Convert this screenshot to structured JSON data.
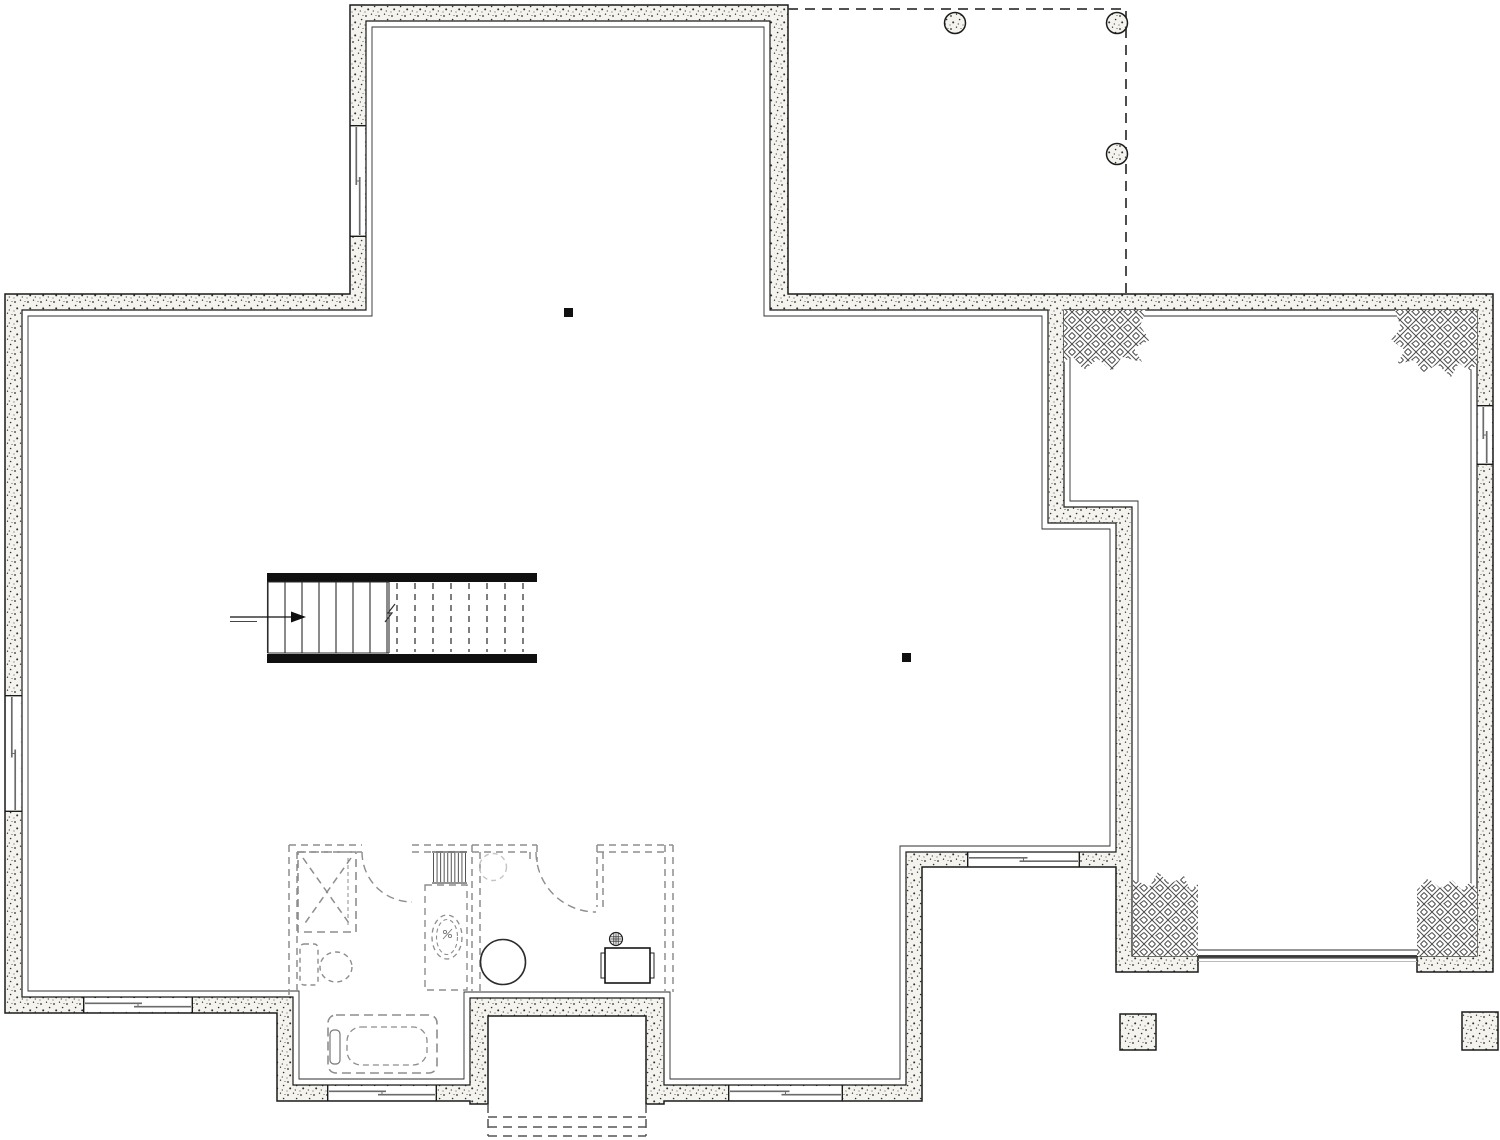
{
  "canvas": {
    "width": 1500,
    "height": 1140
  },
  "colors": {
    "line": "#1b1b1b",
    "face": "#2e2e2e",
    "wall_fill": "#f4f3ee",
    "stipple_dot": "#2f2f2f",
    "hatch": "#4c4c4c",
    "glazing": "#6b6b6b",
    "dash_dark": "#3a3a3a",
    "dash_gray": "#8d8d8d",
    "dash_light": "#c4c4c4",
    "steel": "#101010",
    "background": "#ffffff"
  },
  "outline": {
    "outer": "M350,5 L788,5 L788,294 L1493,294 L1493,972 L1417,972 L1417,956 L1198,956 L1198,972 L1116,972 L1116,867 L922,867 L922,1101 L664,1101 L664,1104 L646,1104 L646,1016 L488,1016 L488,1104 L470,1104 L470,1101 L277,1101 L277,1013 L5,1013 L5,294 L350,294 Z",
    "holes": [
      "M22,310 L366,310 L366,21 L770,21 L770,310 L1048,310 L1048,523 L1116,523 L1116,852 L906,852 L906,1085 L664,1085 L664,998 L470,998 L470,1085 L293,1085 L293,997 L22,997 Z",
      "M1064,310 L1477,310 L1477,956 L1132,956 L1132,507 L1064,507 Z"
    ]
  },
  "faces": [
    "M28,316 L372,316 L372,27 L764,27 L764,316 L1042,316 L1042,529 L1110,529 L1110,846 L900,846 L900,1079 L670,1079 L670,992 L464,992 L464,1079 L299,1079 L299,991 L28,991 Z",
    "M1070,316 L1471,316 L1471,950 L1138,950 L1138,501 L1070,501 Z"
  ],
  "windows": [
    {
      "x": 350,
      "y": 125,
      "w": 16,
      "h": 112,
      "o": "v"
    },
    {
      "x": 5,
      "y": 695,
      "w": 17,
      "h": 117,
      "o": "v"
    },
    {
      "x": 83,
      "y": 997,
      "w": 110,
      "h": 16,
      "o": "h"
    },
    {
      "x": 327,
      "y": 1085,
      "w": 110,
      "h": 16,
      "o": "h"
    },
    {
      "x": 728,
      "y": 1085,
      "w": 115,
      "h": 16,
      "o": "h"
    },
    {
      "x": 967,
      "y": 852,
      "w": 113,
      "h": 15,
      "o": "h"
    },
    {
      "x": 1477,
      "y": 405,
      "w": 16,
      "h": 60,
      "o": "v"
    }
  ],
  "porch": {
    "outline": "M788,9 L1126,9 L1126,294",
    "columns": [
      [
        955,
        23
      ],
      [
        1117,
        23
      ],
      [
        1117,
        154
      ]
    ],
    "radius": 10.5
  },
  "pilasters": [
    "M1064,310 L1146,310 L1140,326 L1150,340 L1134,348 L1142,362 L1122,357 L1112,371 L1098,359 L1084,370 L1072,356 L1064,362 Z",
    "M1477,310 L1395,310 L1401,328 L1391,340 L1405,350 L1397,364 L1415,360 L1423,374 L1437,364 L1451,377 L1459,363 L1469,371 L1477,365 Z",
    "M1133,956 L1133,880 L1150,886 L1158,872 L1170,884 L1184,876 L1190,890 L1198,884 L1198,956 Z",
    "M1417,956 L1417,890 L1428,878 L1440,888 L1452,880 L1462,890 L1470,882 L1477,888 L1477,956 Z"
  ],
  "stairs": {
    "stringers": [
      [
        267,
        573,
        270,
        9
      ],
      [
        267,
        654,
        270,
        9
      ]
    ],
    "tread_top": 582,
    "tread_bot": 653,
    "solid_left": 267.5,
    "solid_right": 389,
    "solid_x": [
      268,
      285,
      302,
      319,
      336,
      353,
      370,
      387
    ],
    "dashed_x": [
      397,
      415,
      433,
      451,
      469,
      487,
      505,
      523
    ],
    "break_path": "M385,622 L392,613 L388,613 L395,604",
    "arrow": {
      "line": [
        230,
        617,
        291,
        617
      ],
      "head": "291,611.5 306,617 291,622.5",
      "tail": [
        230,
        621.5,
        257,
        621.5
      ]
    }
  },
  "posts": {
    "size": 9,
    "at": [
      [
        564,
        308
      ],
      [
        902,
        653
      ]
    ]
  },
  "partitions": [
    [
      289,
      845,
      362,
      845
    ],
    [
      412,
      845,
      537,
      845
    ],
    [
      597,
      845,
      673,
      845
    ],
    [
      297,
      852,
      362,
      852
    ],
    [
      412,
      852,
      530,
      852
    ],
    [
      597,
      852,
      667,
      852
    ],
    [
      289,
      845,
      289,
      995
    ],
    [
      297,
      852,
      297,
      995
    ],
    [
      472,
      845,
      472,
      992
    ],
    [
      480,
      852,
      480,
      992
    ],
    [
      597,
      845,
      597,
      907
    ],
    [
      603,
      852,
      603,
      907
    ],
    [
      537,
      845,
      537,
      862
    ],
    [
      530,
      852,
      530,
      862
    ],
    [
      665,
      845,
      665,
      992
    ],
    [
      673,
      845,
      673,
      992
    ]
  ],
  "doors": [
    "M362,852 A50,50 0 0 0 412,902",
    "M536,852 A60,60 0 0 0 596,912"
  ],
  "shower": {
    "rect": [
      298,
      852,
      58,
      80
    ],
    "diag1": [
      303,
      858,
      351,
      926
    ],
    "diag2": [
      351,
      858,
      303,
      926
    ],
    "door": [
      348,
      858,
      348,
      926
    ]
  },
  "stripes": {
    "x": 432,
    "y": 852,
    "w": 35,
    "h": 31,
    "n": 10
  },
  "toilet": {
    "tank": [
      300,
      944,
      18,
      41
    ],
    "bowl_cx": 336,
    "bowl_cy": 967,
    "rx": 16,
    "ry": 15
  },
  "vanity": {
    "rect": [
      425,
      885,
      42,
      105
    ],
    "sink_cx": 447,
    "sink_cy": 937,
    "sink_rx": 15,
    "sink_ry": 22,
    "inner_rx": 10.5,
    "inner_ry": 17.5
  },
  "water_heater": {
    "cx": 503,
    "cy": 962,
    "r": 22.5
  },
  "desk": {
    "rect": [
      605,
      948,
      45,
      35
    ],
    "tabs": [
      [
        601,
        953,
        4,
        25
      ],
      [
        650,
        953,
        4,
        25
      ]
    ],
    "drain_cx": 616,
    "drain_cy": 939,
    "drain_r": 6.5
  },
  "tub": {
    "outer": [
      328,
      1015,
      109,
      58,
      8
    ],
    "inner": [
      347,
      1027,
      80,
      38,
      14
    ],
    "faucet": [
      330,
      1030,
      10,
      34,
      4
    ]
  },
  "light": {
    "cx": 493,
    "cy": 867,
    "r": 13.5
  },
  "ext_steps": [
    [
      488,
      1104,
      488,
      1136
    ],
    [
      646,
      1104,
      646,
      1136
    ],
    [
      488,
      1117,
      646,
      1117
    ],
    [
      488,
      1127,
      646,
      1127
    ],
    [
      488,
      1136,
      646,
      1136
    ]
  ],
  "threshold": [
    [
      1198,
      957.5,
      1417,
      957.5
    ],
    [
      1198,
      961.5,
      1417,
      961.5
    ]
  ],
  "footings": [
    [
      1120,
      1014,
      36,
      36
    ],
    [
      1462,
      1012,
      36,
      38
    ]
  ]
}
